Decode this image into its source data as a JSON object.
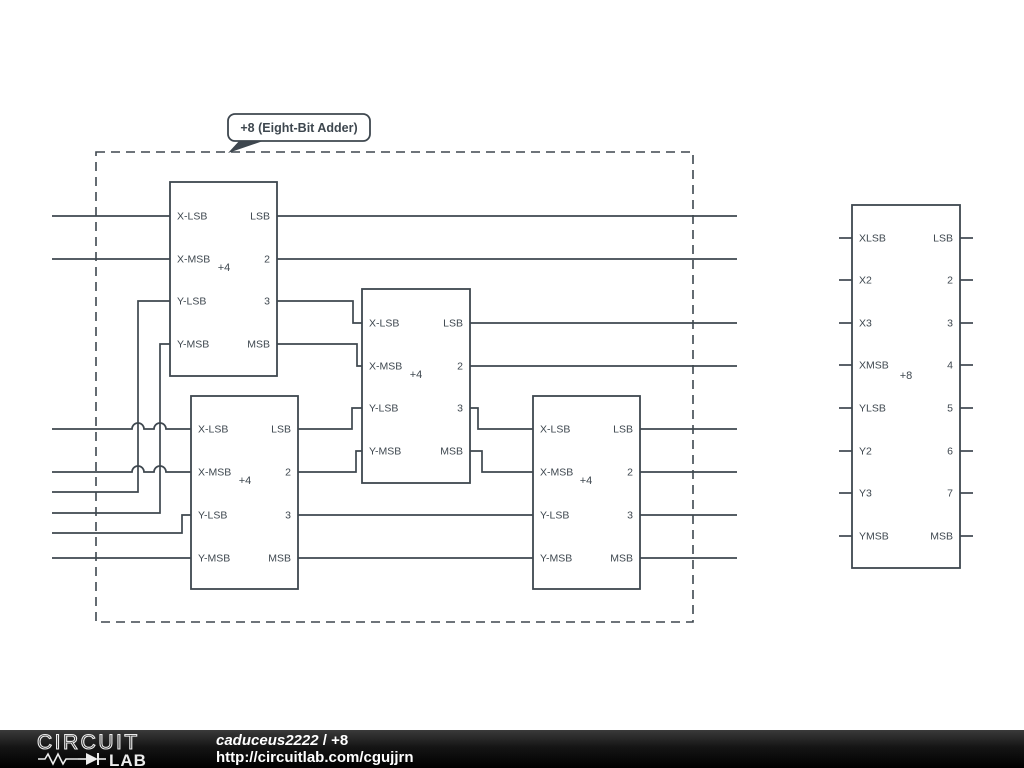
{
  "colors": {
    "stroke": "#3e474f",
    "background": "#ffffff",
    "footer_bg": "#000000",
    "footer_text": "#ffffff"
  },
  "callout": {
    "label": "+8 (Eight-Bit Adder)"
  },
  "schematic": {
    "canvas": {
      "width": 1024,
      "height": 730
    },
    "boundary": {
      "x": 96,
      "y": 152,
      "w": 597,
      "h": 470
    },
    "callout_box": {
      "x": 228,
      "y": 114,
      "w": 142,
      "h": 27,
      "tail": [
        [
          240,
          140
        ],
        [
          266,
          140
        ],
        [
          228,
          153
        ]
      ],
      "text_x": 299,
      "text_y": 132
    },
    "blocks": [
      {
        "id": "adder4-a",
        "x": 170,
        "y": 182,
        "w": 107,
        "h": 194,
        "label": "+4",
        "label_x": 224,
        "label_y": 271,
        "stub_len": 0,
        "left_pins": [
          {
            "name": "X-LSB",
            "y": 216
          },
          {
            "name": "X-MSB",
            "y": 259
          },
          {
            "name": "Y-LSB",
            "y": 301
          },
          {
            "name": "Y-MSB",
            "y": 344
          }
        ],
        "right_pins": [
          {
            "name": "LSB",
            "y": 216
          },
          {
            "name": "2",
            "y": 259
          },
          {
            "name": "3",
            "y": 301
          },
          {
            "name": "MSB",
            "y": 344
          }
        ]
      },
      {
        "id": "adder4-b",
        "x": 362,
        "y": 289,
        "w": 108,
        "h": 194,
        "label": "+4",
        "label_x": 416,
        "label_y": 378,
        "stub_len": 0,
        "left_pins": [
          {
            "name": "X-LSB",
            "y": 323
          },
          {
            "name": "X-MSB",
            "y": 366
          },
          {
            "name": "Y-LSB",
            "y": 408
          },
          {
            "name": "Y-MSB",
            "y": 451
          }
        ],
        "right_pins": [
          {
            "name": "LSB",
            "y": 323
          },
          {
            "name": "2",
            "y": 366
          },
          {
            "name": "3",
            "y": 408
          },
          {
            "name": "MSB",
            "y": 451
          }
        ]
      },
      {
        "id": "adder4-c",
        "x": 191,
        "y": 396,
        "w": 107,
        "h": 193,
        "label": "+4",
        "label_x": 245,
        "label_y": 484,
        "stub_len": 0,
        "left_pins": [
          {
            "name": "X-LSB",
            "y": 429
          },
          {
            "name": "X-MSB",
            "y": 472
          },
          {
            "name": "Y-LSB",
            "y": 515
          },
          {
            "name": "Y-MSB",
            "y": 558
          }
        ],
        "right_pins": [
          {
            "name": "LSB",
            "y": 429
          },
          {
            "name": "2",
            "y": 472
          },
          {
            "name": "3",
            "y": 515
          },
          {
            "name": "MSB",
            "y": 558
          }
        ]
      },
      {
        "id": "adder4-d",
        "x": 533,
        "y": 396,
        "w": 107,
        "h": 193,
        "label": "+4",
        "label_x": 586,
        "label_y": 484,
        "stub_len": 0,
        "left_pins": [
          {
            "name": "X-LSB",
            "y": 429
          },
          {
            "name": "X-MSB",
            "y": 472
          },
          {
            "name": "Y-LSB",
            "y": 515
          },
          {
            "name": "Y-MSB",
            "y": 558
          }
        ],
        "right_pins": [
          {
            "name": "LSB",
            "y": 429
          },
          {
            "name": "2",
            "y": 472
          },
          {
            "name": "3",
            "y": 515
          },
          {
            "name": "MSB",
            "y": 558
          }
        ]
      },
      {
        "id": "adder8-symbol",
        "x": 852,
        "y": 205,
        "w": 108,
        "h": 363,
        "label": "+8",
        "label_x": 906,
        "label_y": 379,
        "stub_len": 13,
        "left_pins": [
          {
            "name": "XLSB",
            "y": 238
          },
          {
            "name": "X2",
            "y": 280
          },
          {
            "name": "X3",
            "y": 323
          },
          {
            "name": "XMSB",
            "y": 365
          },
          {
            "name": "YLSB",
            "y": 408
          },
          {
            "name": "Y2",
            "y": 451
          },
          {
            "name": "Y3",
            "y": 493
          },
          {
            "name": "YMSB",
            "y": 536
          }
        ],
        "right_pins": [
          {
            "name": "LSB",
            "y": 238
          },
          {
            "name": "2",
            "y": 280
          },
          {
            "name": "3",
            "y": 323
          },
          {
            "name": "4",
            "y": 365
          },
          {
            "name": "5",
            "y": 408
          },
          {
            "name": "6",
            "y": 451
          },
          {
            "name": "7",
            "y": 493
          },
          {
            "name": "MSB",
            "y": 536
          }
        ]
      }
    ],
    "wires": [
      {
        "name": "input-top-x-lsb",
        "points": [
          [
            52,
            216
          ],
          [
            170,
            216
          ]
        ]
      },
      {
        "name": "input-top-x-msb",
        "points": [
          [
            52,
            259
          ],
          [
            170,
            259
          ]
        ]
      },
      {
        "name": "input-bottom-x-lsb",
        "points": [
          [
            52,
            429
          ],
          [
            191,
            429
          ]
        ],
        "hops": [
          138,
          160
        ]
      },
      {
        "name": "input-bottom-x-msb",
        "points": [
          [
            52,
            472
          ],
          [
            191,
            472
          ]
        ],
        "hops": [
          138,
          160
        ]
      },
      {
        "name": "input-top-y-lsb",
        "points": [
          [
            52,
            492
          ],
          [
            138,
            492
          ],
          [
            138,
            301
          ],
          [
            170,
            301
          ]
        ]
      },
      {
        "name": "input-top-y-msb",
        "points": [
          [
            52,
            513
          ],
          [
            160,
            513
          ],
          [
            160,
            344
          ],
          [
            170,
            344
          ]
        ]
      },
      {
        "name": "input-bottom-y-lsb",
        "points": [
          [
            52,
            533
          ],
          [
            182,
            533
          ],
          [
            182,
            515
          ],
          [
            191,
            515
          ]
        ]
      },
      {
        "name": "input-bottom-y-msb",
        "points": [
          [
            52,
            558
          ],
          [
            191,
            558
          ]
        ]
      },
      {
        "name": "top3-to-mid-x-lsb",
        "points": [
          [
            277,
            301
          ],
          [
            353,
            301
          ],
          [
            353,
            323
          ],
          [
            362,
            323
          ]
        ]
      },
      {
        "name": "topmsb-to-mid-x-msb",
        "points": [
          [
            277,
            344
          ],
          [
            357,
            344
          ],
          [
            357,
            366
          ],
          [
            362,
            366
          ]
        ]
      },
      {
        "name": "botlsb-to-mid-y-lsb",
        "points": [
          [
            298,
            429
          ],
          [
            352,
            429
          ],
          [
            352,
            408
          ],
          [
            362,
            408
          ]
        ]
      },
      {
        "name": "bot2-to-mid-y-msb",
        "points": [
          [
            298,
            472
          ],
          [
            356,
            472
          ],
          [
            356,
            451
          ],
          [
            362,
            451
          ]
        ]
      },
      {
        "name": "bot3-to-right-y-lsb",
        "points": [
          [
            298,
            515
          ],
          [
            533,
            515
          ]
        ]
      },
      {
        "name": "botmsb-to-right-y-msb",
        "points": [
          [
            298,
            558
          ],
          [
            533,
            558
          ]
        ]
      },
      {
        "name": "mid3-to-right-x-lsb",
        "points": [
          [
            470,
            408
          ],
          [
            478,
            408
          ],
          [
            478,
            429
          ],
          [
            533,
            429
          ]
        ]
      },
      {
        "name": "midmsb-to-right-x-msb",
        "points": [
          [
            470,
            451
          ],
          [
            482,
            451
          ],
          [
            482,
            472
          ],
          [
            533,
            472
          ]
        ]
      },
      {
        "name": "output-bit1-lsb",
        "points": [
          [
            277,
            216
          ],
          [
            737,
            216
          ]
        ]
      },
      {
        "name": "output-bit2",
        "points": [
          [
            277,
            259
          ],
          [
            737,
            259
          ]
        ]
      },
      {
        "name": "output-bit3",
        "points": [
          [
            470,
            323
          ],
          [
            737,
            323
          ]
        ]
      },
      {
        "name": "output-bit4",
        "points": [
          [
            470,
            366
          ],
          [
            737,
            366
          ]
        ]
      },
      {
        "name": "output-bit5",
        "points": [
          [
            640,
            429
          ],
          [
            737,
            429
          ]
        ]
      },
      {
        "name": "output-bit6",
        "points": [
          [
            640,
            472
          ],
          [
            737,
            472
          ]
        ]
      },
      {
        "name": "output-bit7",
        "points": [
          [
            640,
            515
          ],
          [
            737,
            515
          ]
        ]
      },
      {
        "name": "output-bit8-msb",
        "points": [
          [
            640,
            558
          ],
          [
            737,
            558
          ]
        ]
      }
    ]
  },
  "footer": {
    "logo_line1": "CIRCUIT",
    "logo_line2": "LAB",
    "author": "caduceus2222",
    "separator": " / ",
    "title": "+8",
    "url": "http://circuitlab.com/cgujjrn"
  }
}
